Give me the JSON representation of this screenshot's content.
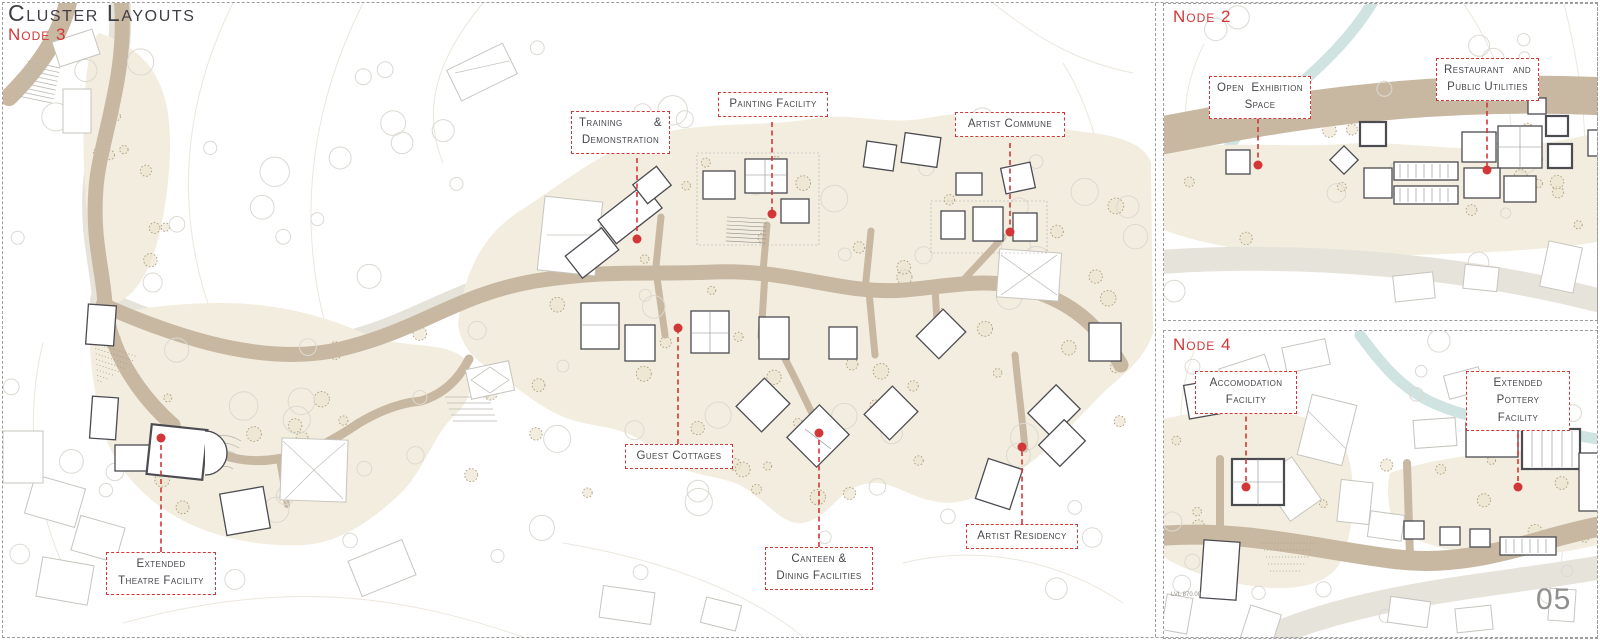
{
  "page": {
    "title": "Cluster Layouts",
    "number": "05"
  },
  "colors": {
    "accent": "#d23737",
    "road": "#c8b8a2",
    "site": "#f2edde",
    "stream": "#cfe3e1",
    "ink": "#45454b"
  },
  "node3": {
    "title": "Node 3",
    "callouts": {
      "training": {
        "a": "Training",
        "b": "&",
        "c": "Demonstration"
      },
      "painting": {
        "a": "Painting Facility"
      },
      "commune": {
        "a": "Artist Commune"
      },
      "guest": {
        "a": "Guest Cottages"
      },
      "canteen": {
        "a": "Canteen &",
        "b": "Dining Facilities"
      },
      "residency": {
        "a": "Artist Residency"
      },
      "theatre": {
        "a": "Extended",
        "b": "Theatre Facility"
      }
    }
  },
  "node2": {
    "title": "Node 2",
    "callouts": {
      "exhibition": {
        "a": "Open",
        "b": "Exhibition",
        "c": "Space"
      },
      "restaurant": {
        "a": "Restaurant",
        "b": "and",
        "c": "Public Utilities"
      }
    }
  },
  "node4": {
    "title": "Node 4",
    "level_label": "LVL 870.00",
    "callouts": {
      "accommodation": {
        "a": "Accomodation",
        "b": "Facility"
      },
      "pottery": {
        "a": "Extended Pottery",
        "b": "Facility"
      }
    }
  }
}
